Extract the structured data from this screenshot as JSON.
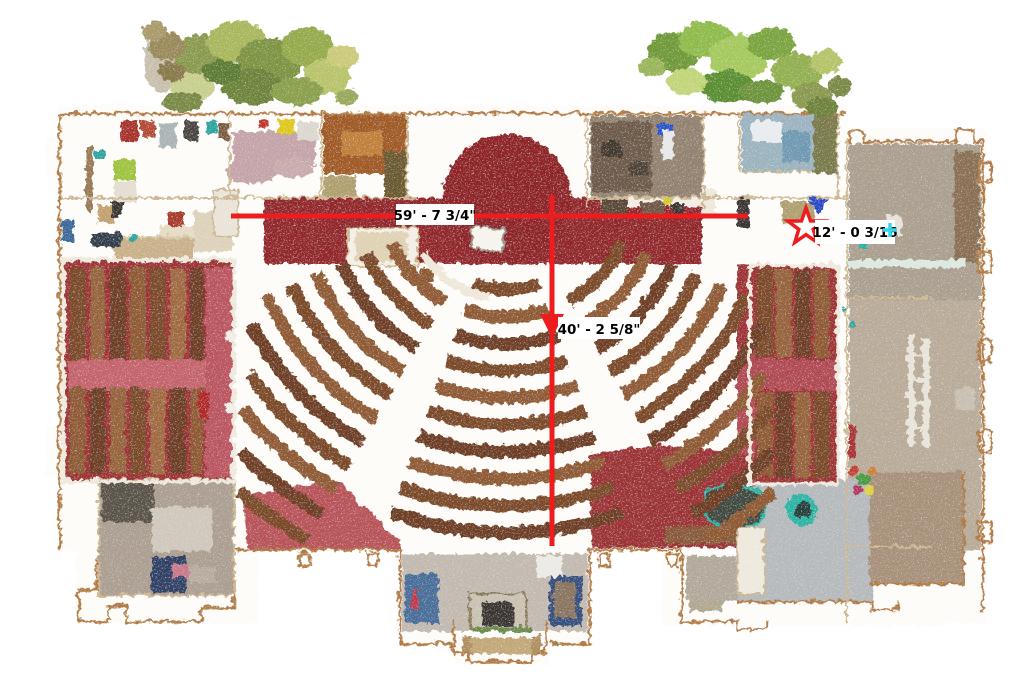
{
  "scene": {
    "type": "point-cloud orthographic floor plan (top view)",
    "subject": "Church sanctuary scan with fan-shaped curved pews, chancel, side wings and annex halls",
    "background": "#ffffff"
  },
  "annotations": {
    "color": "#ec1c1f",
    "label_bg": "#ffffff",
    "label_text_color": "#000000",
    "marker_cyan": "#35d8e8",
    "labels": {
      "horizontal": "59' - 7 3/4\"",
      "vertical": "40' - 2 5/8\"",
      "star": "12' - 0 3/16"
    },
    "markers": {
      "star": "star-icon",
      "arrow": "arrow-down-icon",
      "cross": "cyan-cross-marker"
    }
  },
  "palette": {
    "carpet_red": "#93282b",
    "aisle_pink": "#c4646c",
    "pew_wood_brown": "#7c4827",
    "foliage_green": "#7fae3f",
    "wall_tan": "#b07a42",
    "annex_beige": "#b3a493",
    "concrete_gray": "#b6babc"
  }
}
